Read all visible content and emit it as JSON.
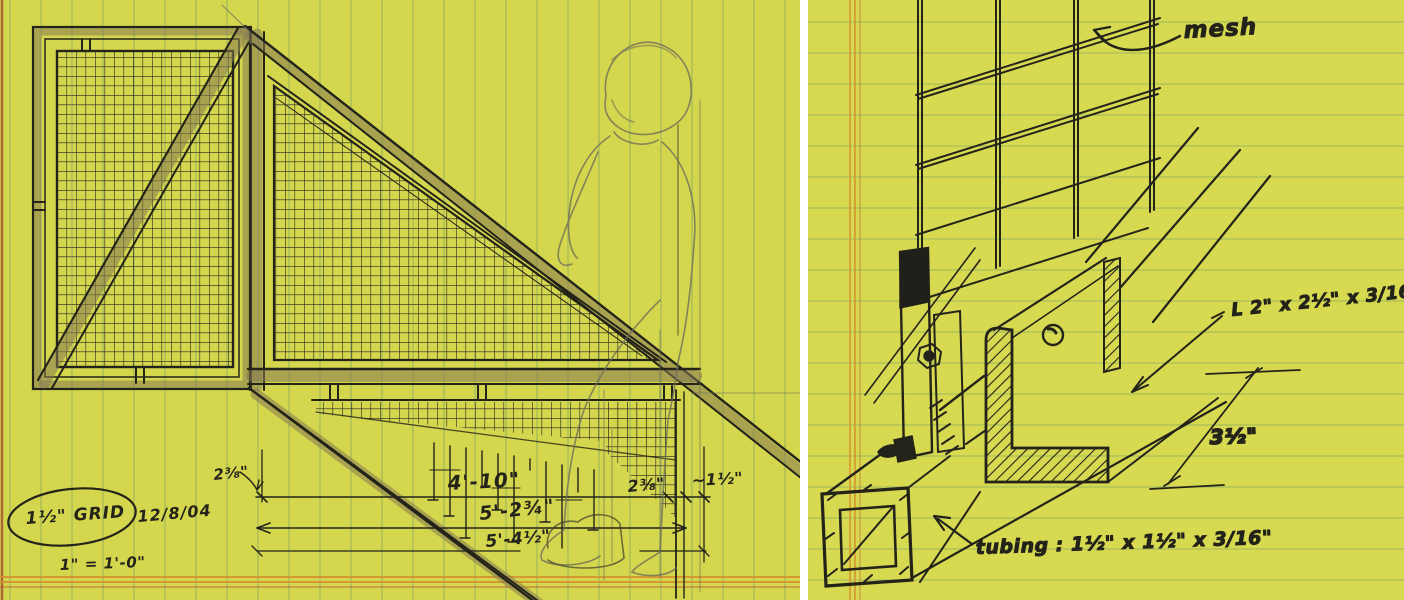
{
  "document": {
    "type": "hand-drawn stair railing sketch on yellow legal pad",
    "panels": [
      "elevation-view",
      "base-connection-detail"
    ]
  },
  "colors": {
    "paper": "#d4d64e",
    "paper_right": "#d7d951",
    "rule_green": "#7fa465",
    "margin_orange": "#d6922f",
    "margin_red": "#c05b2b",
    "ink": "#23231a",
    "pencil": "#6f6f5a",
    "wood": "#8a7e54"
  },
  "left": {
    "notes": {
      "grid_note": "1½\" GRID",
      "date": "12/8/04",
      "scale_note": "1\" = 1'-0\""
    },
    "dims": {
      "offset_left": "2⅜\"",
      "run": "4'-10\"",
      "offset_right": "2⅜\"",
      "edge_gap": "~1½\"",
      "overall_1": "5'-2¾\"",
      "overall_2": "5'-4½\""
    }
  },
  "right": {
    "labels": {
      "mesh": "mesh",
      "angle_spec": "L 2\" x 2½\" x 3/16\"",
      "depth_dim": "3½\"",
      "tubing_spec": "tubing : 1½\" x 1½\" x 3/16\""
    }
  }
}
